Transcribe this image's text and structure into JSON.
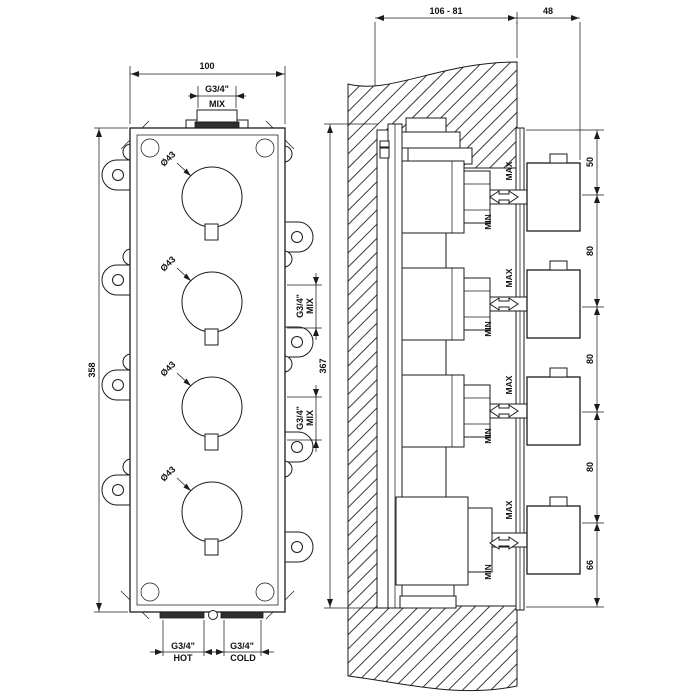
{
  "front_view": {
    "width_dim": "100",
    "top_port_thread": "G3/4\"",
    "top_port_label": "MIX",
    "height_dim": "358",
    "knob_diameter": "Ø43",
    "side_port_thread": "G3/4\"",
    "side_port_label": "MIX",
    "hot_port_thread": "G3/4\"",
    "hot_port_label": "HOT",
    "cold_port_thread": "G3/4\"",
    "cold_port_label": "COLD"
  },
  "section_view": {
    "recess_depth_dim": "106 - 81",
    "handle_projection_dim": "48",
    "height_dim": "367",
    "spacing_dims": [
      "50",
      "80",
      "80",
      "80",
      "66"
    ],
    "adjustment_max": "MAX",
    "adjustment_min": "MIN"
  }
}
